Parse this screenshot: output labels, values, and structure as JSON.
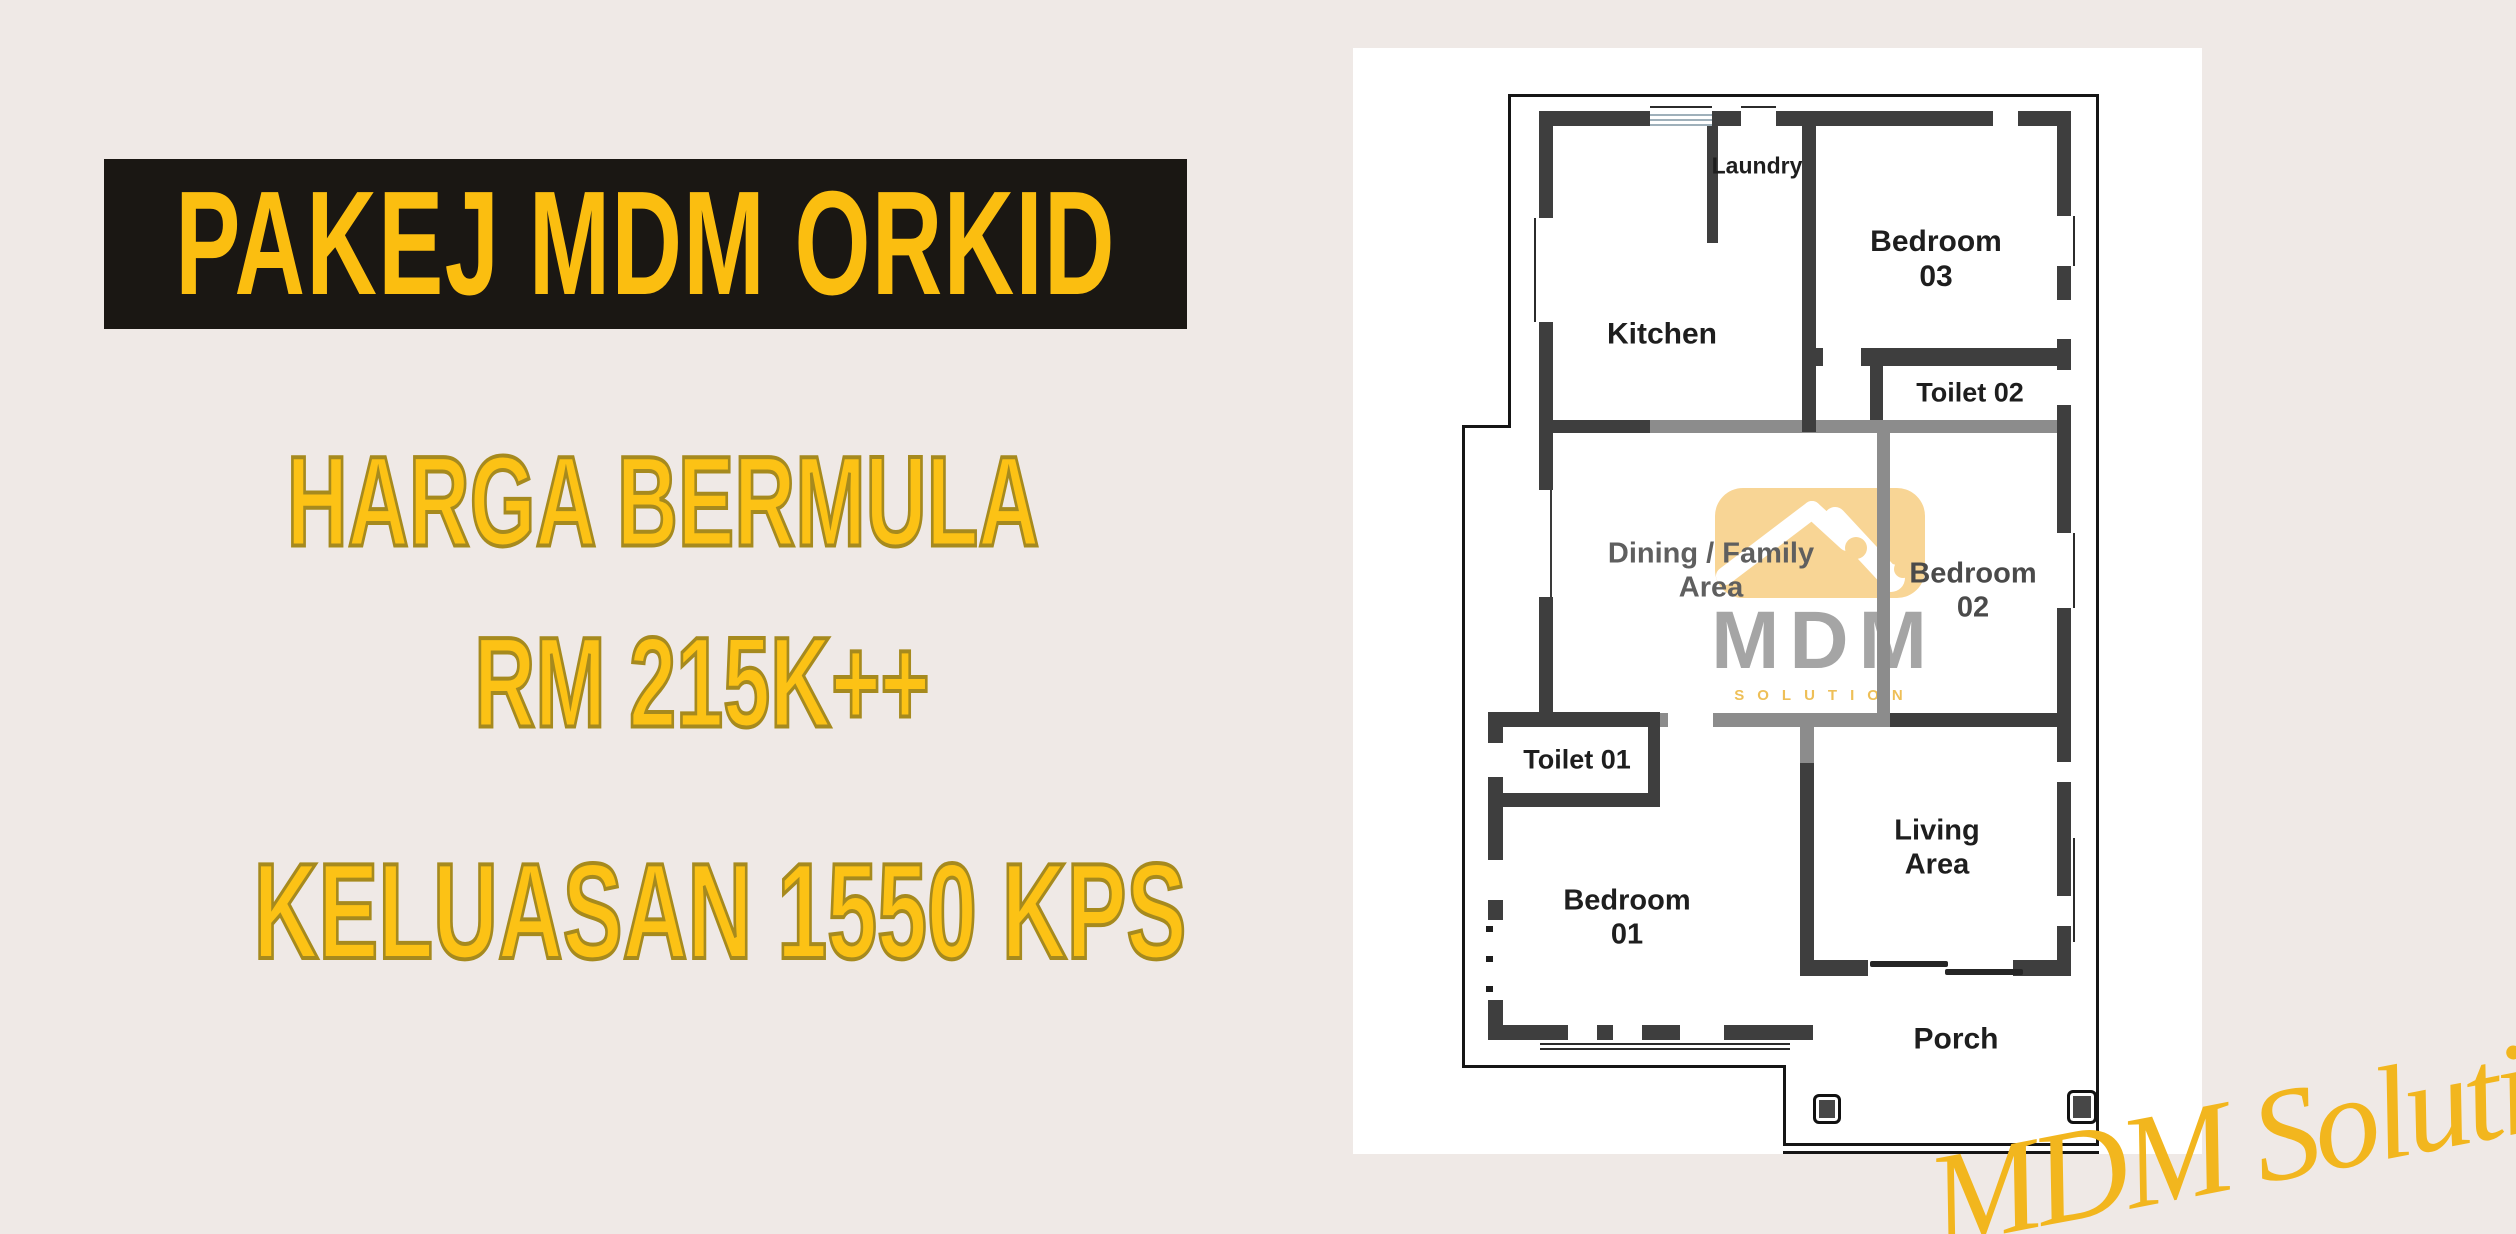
{
  "page": {
    "bg": "#EFE9E6"
  },
  "promo": {
    "title": "PAKEJ MDM ORKID",
    "price_line1": "HARGA BERMULA",
    "price_line2": "RM 215K++",
    "area_line": "KELUASAN 1550 KPS",
    "banner_bg": "#1A1713",
    "accent": "#FBBE10",
    "accent_fill": "#FCC215",
    "accent_stroke": "#A68A1E"
  },
  "floorplan": {
    "panel_bg": "#FFFFFF",
    "wall_color": "#3E3E3E",
    "partition_color": "#8C8C8C",
    "rooms": [
      {
        "id": "laundry",
        "label": "Laundry"
      },
      {
        "id": "kitchen",
        "label": "Kitchen"
      },
      {
        "id": "bedroom-03",
        "label": "Bedroom\n03"
      },
      {
        "id": "toilet-02",
        "label": "Toilet 02"
      },
      {
        "id": "dining-family",
        "label": "Dining / Family\nArea"
      },
      {
        "id": "bedroom-02",
        "label": "Bedroom\n02"
      },
      {
        "id": "toilet-01",
        "label": "Toilet 01"
      },
      {
        "id": "bedroom-01",
        "label": "Bedroom\n01"
      },
      {
        "id": "living",
        "label": "Living\nArea"
      },
      {
        "id": "porch",
        "label": "Porch"
      }
    ]
  },
  "watermark": {
    "brand": "MDM",
    "subtitle": "SOLUTION",
    "box_color": "#F8D18A",
    "brand_color": "#9C9C9C",
    "subtitle_color": "#EDB945"
  },
  "signature": {
    "text": "MDM Solution",
    "color": "#F2B61E"
  }
}
